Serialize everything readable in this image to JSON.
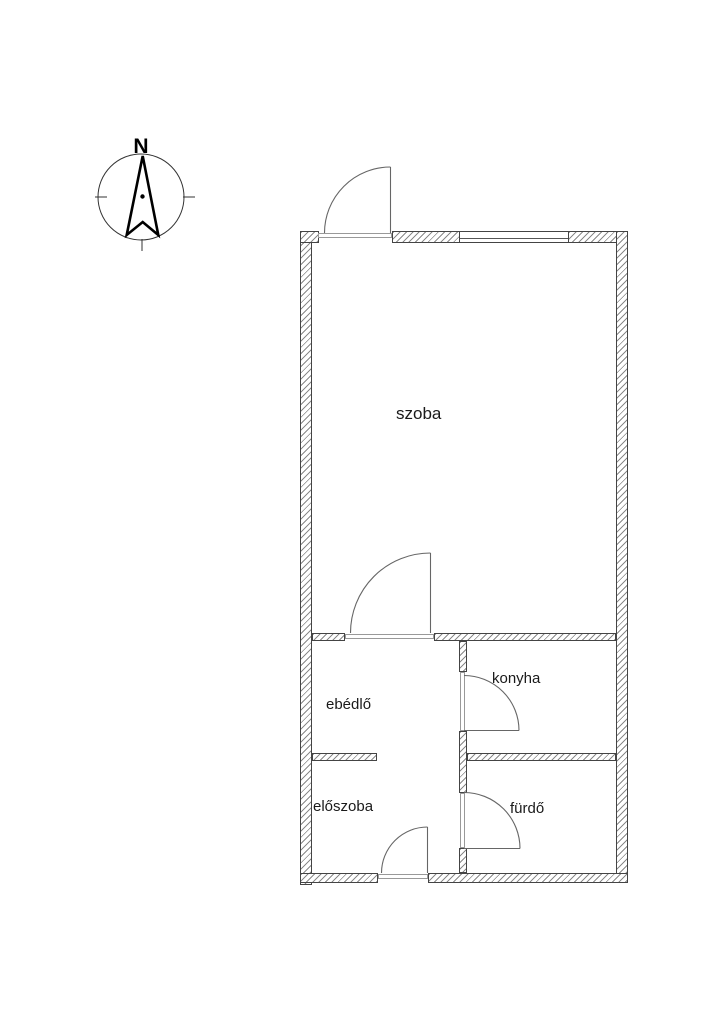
{
  "floor_plan": {
    "compass": {
      "north_label": "N"
    },
    "rooms": [
      {
        "id": "szoba",
        "label": "szoba"
      },
      {
        "id": "ebedlo",
        "label": "ebédlő"
      },
      {
        "id": "konyha",
        "label": "konyha"
      },
      {
        "id": "eloszoba",
        "label": "előszoba"
      },
      {
        "id": "furdo",
        "label": "fürdő"
      }
    ],
    "doors": [
      {
        "id": "terrace-door",
        "location": "top exterior wall, opens outward"
      },
      {
        "id": "szoba-door",
        "location": "between szoba and ebédlő, opens into szoba"
      },
      {
        "id": "konyha-door",
        "location": "between ebédlő and konyha, opens into konyha"
      },
      {
        "id": "furdo-door",
        "location": "between előszoba and fürdő, opens into fürdő"
      },
      {
        "id": "entry-door",
        "location": "bottom exterior wall, opens into előszoba"
      }
    ],
    "windows": [
      {
        "id": "top-window",
        "location": "top exterior wall, right of terrace door"
      }
    ],
    "colors": {
      "background": "#ffffff",
      "wall_outline": "#444444",
      "wall_hatch": "#8a8a8a",
      "door_line": "#666666",
      "text": "#1a1a1a"
    }
  }
}
